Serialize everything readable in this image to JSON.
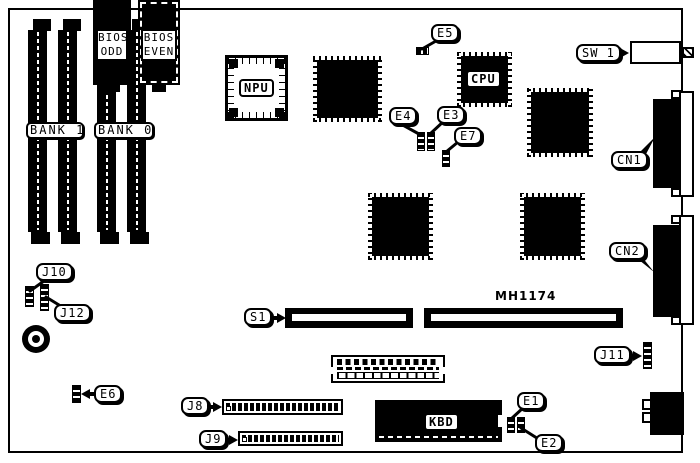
{
  "board": {
    "part_number": "MH1174",
    "colors": {
      "ink": "#000000",
      "paper": "#ffffff"
    }
  },
  "memory": {
    "bank1": "BANK 1",
    "bank0": "BANK 0"
  },
  "chips": {
    "npu": "NPU",
    "cpu": "CPU",
    "kbd": "KBD",
    "bios_odd": {
      "line1": "BIOS",
      "line2": "ODD"
    },
    "bios_even": {
      "line1": "BIOS",
      "line2": "EVEN"
    }
  },
  "callouts": {
    "e1": "E1",
    "e2": "E2",
    "e3": "E3",
    "e4": "E4",
    "e5": "E5",
    "e6": "E6",
    "e7": "E7",
    "j8": "J8",
    "j9": "J9",
    "j10": "J10",
    "j11": "J11",
    "j12": "J12",
    "s1": "S1",
    "sw1": "SW 1",
    "cn1": "CN1",
    "cn2": "CN2"
  }
}
